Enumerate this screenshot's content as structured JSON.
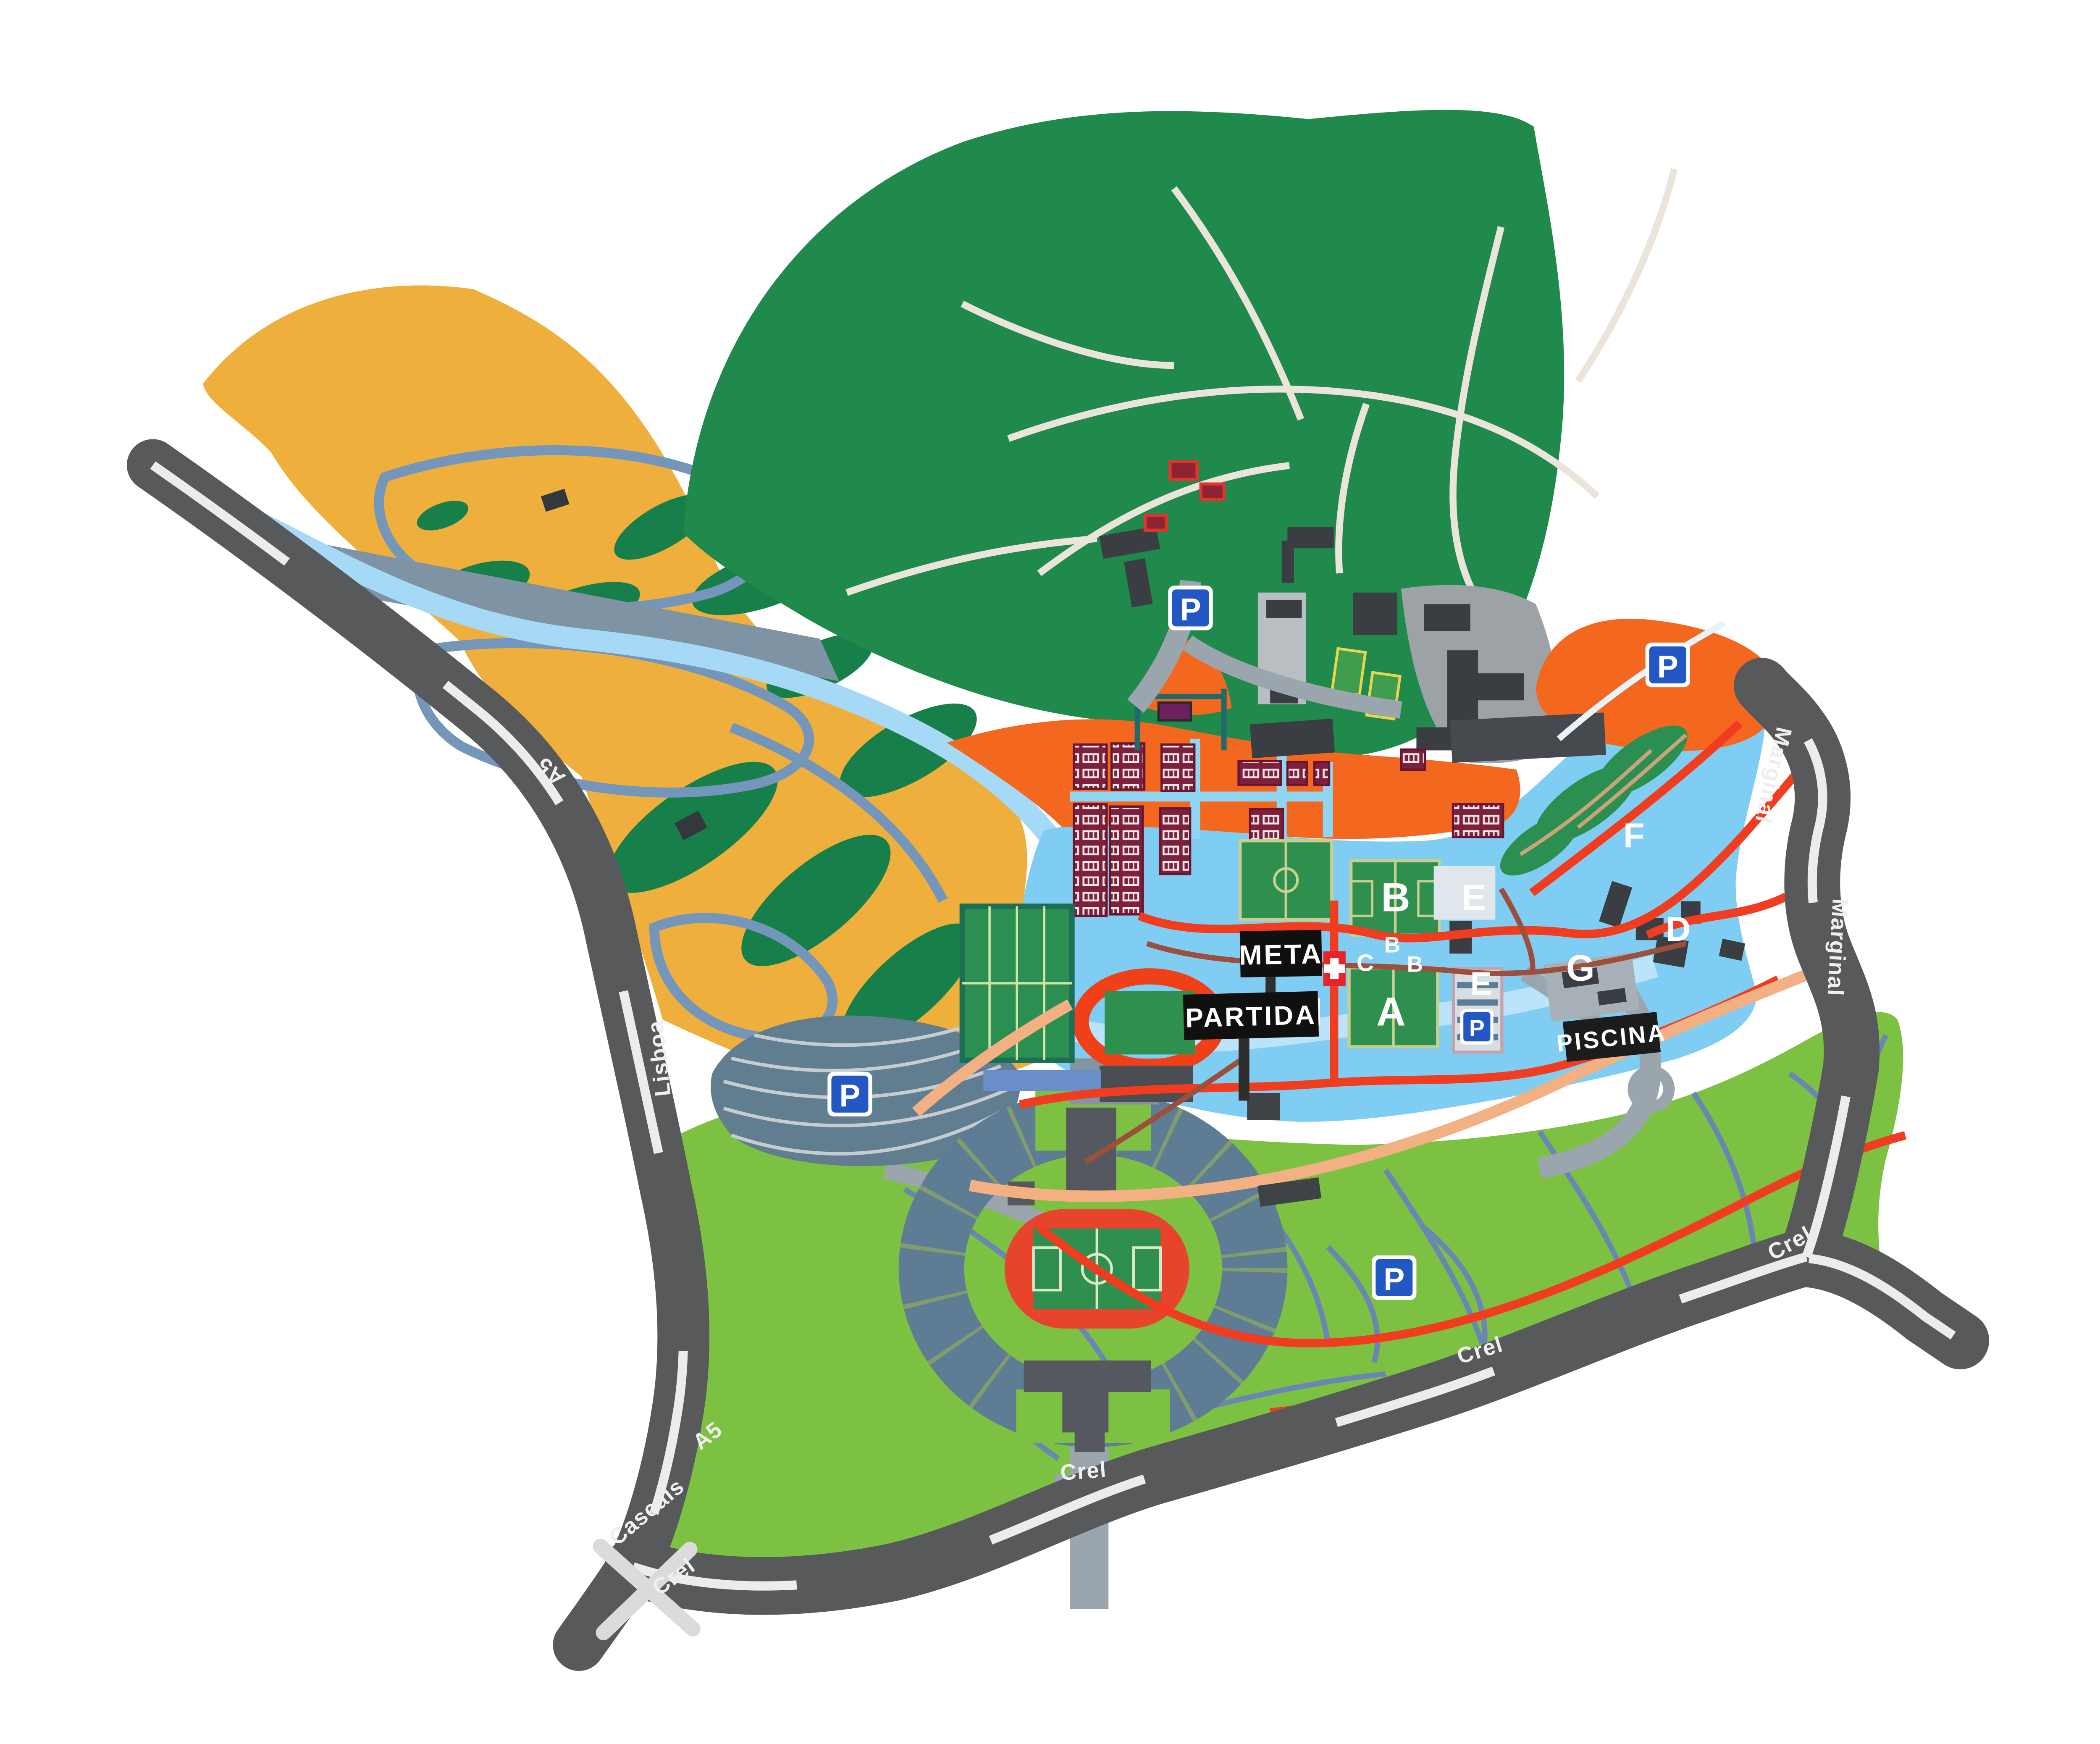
{
  "labels": {
    "meta": "META",
    "partida": "PARTIDA",
    "piscina": "PISCINA"
  },
  "roads": {
    "a5": "A5",
    "lisboa": "Lisboa",
    "cascais": "Cascais",
    "crel": "Crel",
    "marginal": "Marginal"
  },
  "letters": {
    "a": "A",
    "b": "B",
    "c": "C",
    "d": "D",
    "e": "E",
    "f": "F",
    "g": "G",
    "h": "H"
  },
  "signs": {
    "parking": "P"
  },
  "icons": {
    "first_aid": "first-aid-cross",
    "interchange": "road-interchange-x",
    "parking": "parking-square"
  },
  "palette": {
    "road": "#58595b",
    "road_dash": "#ececec",
    "forest": "#1f8a4c",
    "golf": "#eeaf3c",
    "camp": "#f4671f",
    "water_zone": "#7fcdf2",
    "river": "#a6d9f5",
    "park": "#7cc142",
    "field_green": "#2f8f4e",
    "track_red": "#e8432b",
    "course_red": "#f23c20",
    "label_bg": "#101010",
    "label_text": "#ffffff",
    "parking_blue": "#2257c4",
    "bungalow": "#7e1f3e",
    "building_dark": "#4a4d52",
    "stands": "#5e7c93",
    "path_blue": "#7496ba"
  }
}
